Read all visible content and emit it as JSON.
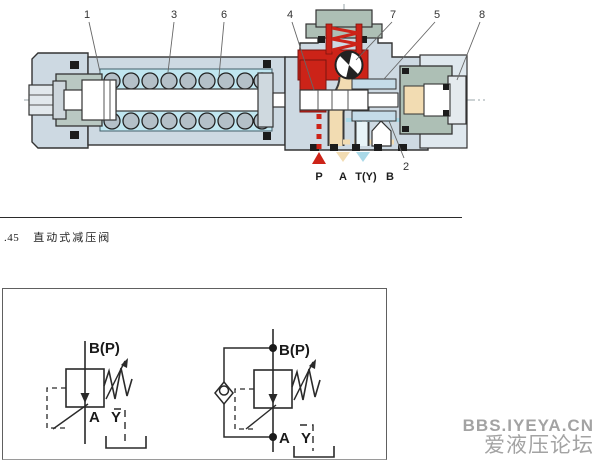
{
  "figure": {
    "callouts": [
      "1",
      "3",
      "6",
      "4",
      "7",
      "5",
      "8",
      "2"
    ],
    "ports": {
      "p": "P",
      "a": "A",
      "t": "T(Y)",
      "b": "B"
    },
    "colors": {
      "pressure_red": "#cc2318",
      "reduced_tan": "#f2dcb2",
      "drain_blue": "#aad9e8",
      "body_gray_blue": "#cdd9e2",
      "spring_chamber_cyan": "#c0e6f0",
      "cap_green": "#adbfb5"
    }
  },
  "caption": {
    "number": ".45",
    "title": "直动式减压阀"
  },
  "schematic": {
    "left": {
      "top": "B(P)",
      "out": "A",
      "drain": "Y"
    },
    "right": {
      "top": "B(P)",
      "out": "A",
      "drain": "Y"
    }
  },
  "watermark": {
    "site": "BBS.IYEYA.CN",
    "name": "爱液压论坛"
  }
}
